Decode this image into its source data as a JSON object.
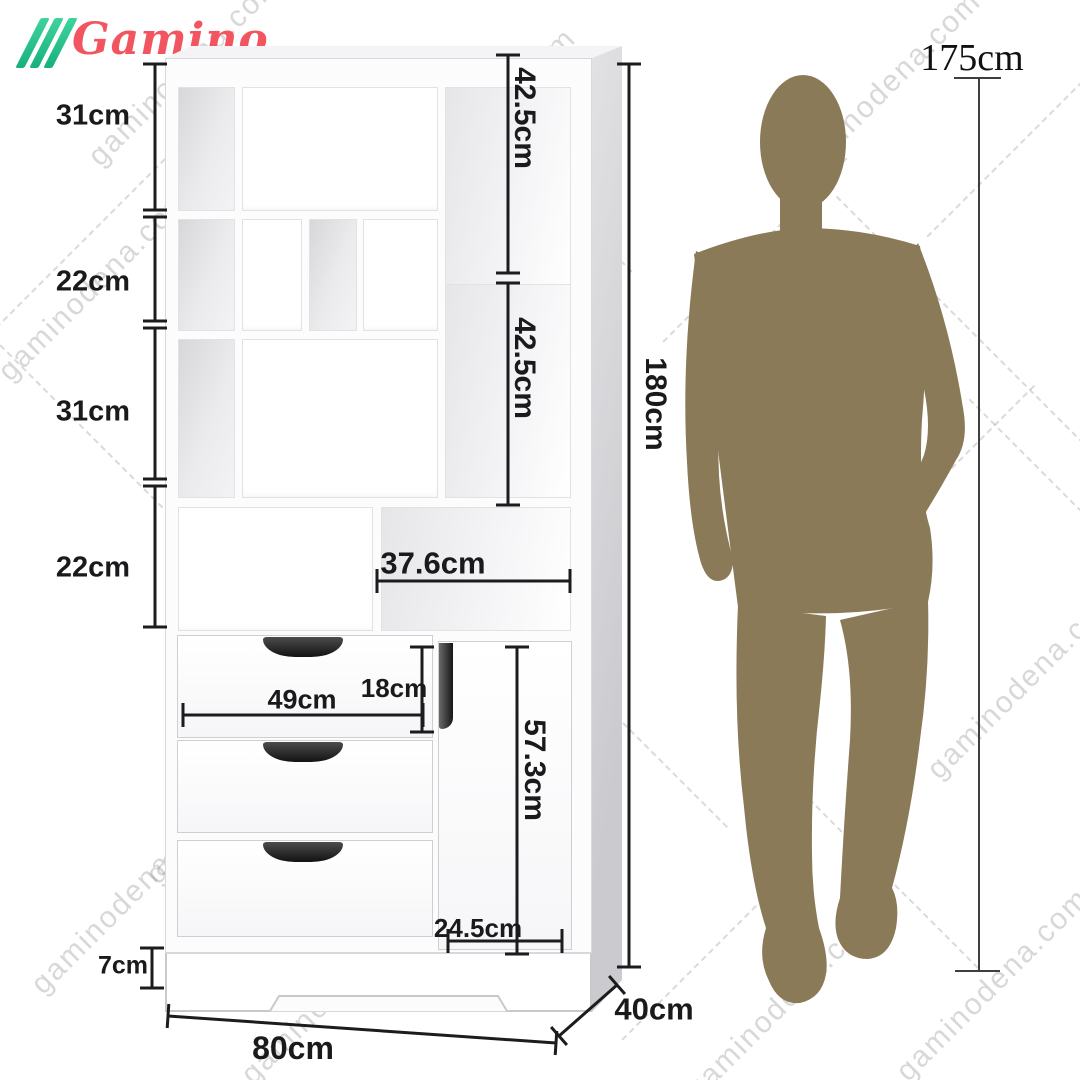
{
  "brand": {
    "name": "Gamino",
    "logo_color": "#f2555f",
    "stripe_color": "#2ec98f"
  },
  "watermark": {
    "text": "gaminodena.com"
  },
  "person": {
    "height": "175cm",
    "silhouette_color": "#8a7a57"
  },
  "cabinet": {
    "color": "#ffffff",
    "dimensions": {
      "left_sections": [
        "31cm",
        "22cm",
        "31cm",
        "22cm"
      ],
      "right_shelf_top": "42.5cm",
      "right_shelf_bottom": "42.5cm",
      "total_height": "180cm",
      "open_shelf_width": "37.6cm",
      "drawer_height": "18cm",
      "drawer_width": "49cm",
      "door_height": "57.3cm",
      "door_width": "24.5cm",
      "base_height": "7cm",
      "width": "80cm",
      "depth": "40cm"
    }
  }
}
